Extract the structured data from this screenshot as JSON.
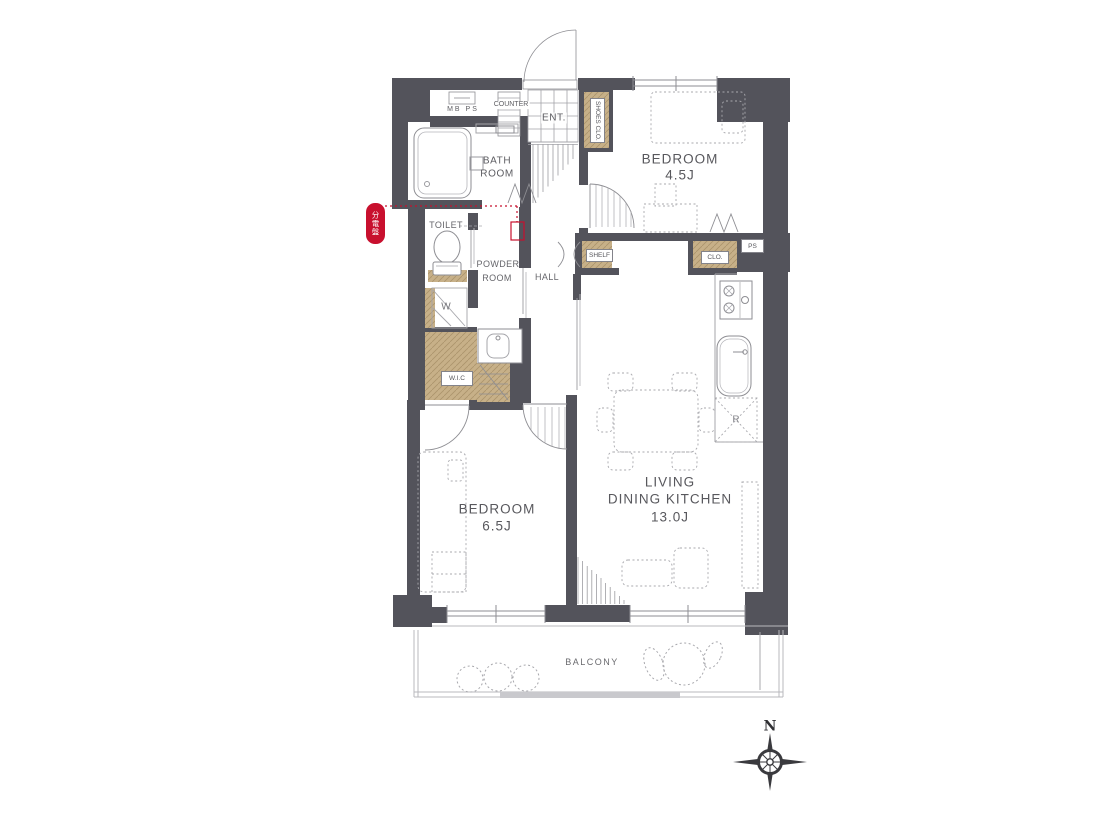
{
  "meta": {
    "type": "apartment-floor-plan"
  },
  "colors": {
    "wall": "#53535b",
    "storage_tan": "#c7b088",
    "accent_red": "#c8102e",
    "line_gray": "#8e8e93",
    "light_gray": "#b9b9be",
    "text_gray": "#5d5d62"
  },
  "rooms": {
    "bedroom1": {
      "name": "BEDROOM",
      "size": "4.5J"
    },
    "bedroom2": {
      "name": "BEDROOM",
      "size": "6.5J"
    },
    "ldk": {
      "line1": "LIVING",
      "line2": "DINING KITCHEN",
      "size": "13.0J"
    },
    "bath": {
      "line1": "BATH",
      "line2": "ROOM"
    },
    "powder": {
      "line1": "POWDER",
      "line2": "ROOM"
    },
    "toilet": "TOILET",
    "hall": "HALL",
    "ent": "ENT.",
    "balcony": "BALCONY"
  },
  "fixtures": {
    "counter": "COUNTER",
    "mb_ps": "MB  PS",
    "shoes_clo": "SHOES CLO.",
    "shelf": "SHELF",
    "clo": "CLO.",
    "ps": "PS",
    "wic": "W.I.C",
    "washer": "W",
    "fridge": "R",
    "dist_board": "分電盤"
  },
  "compass": {
    "north": "N"
  }
}
